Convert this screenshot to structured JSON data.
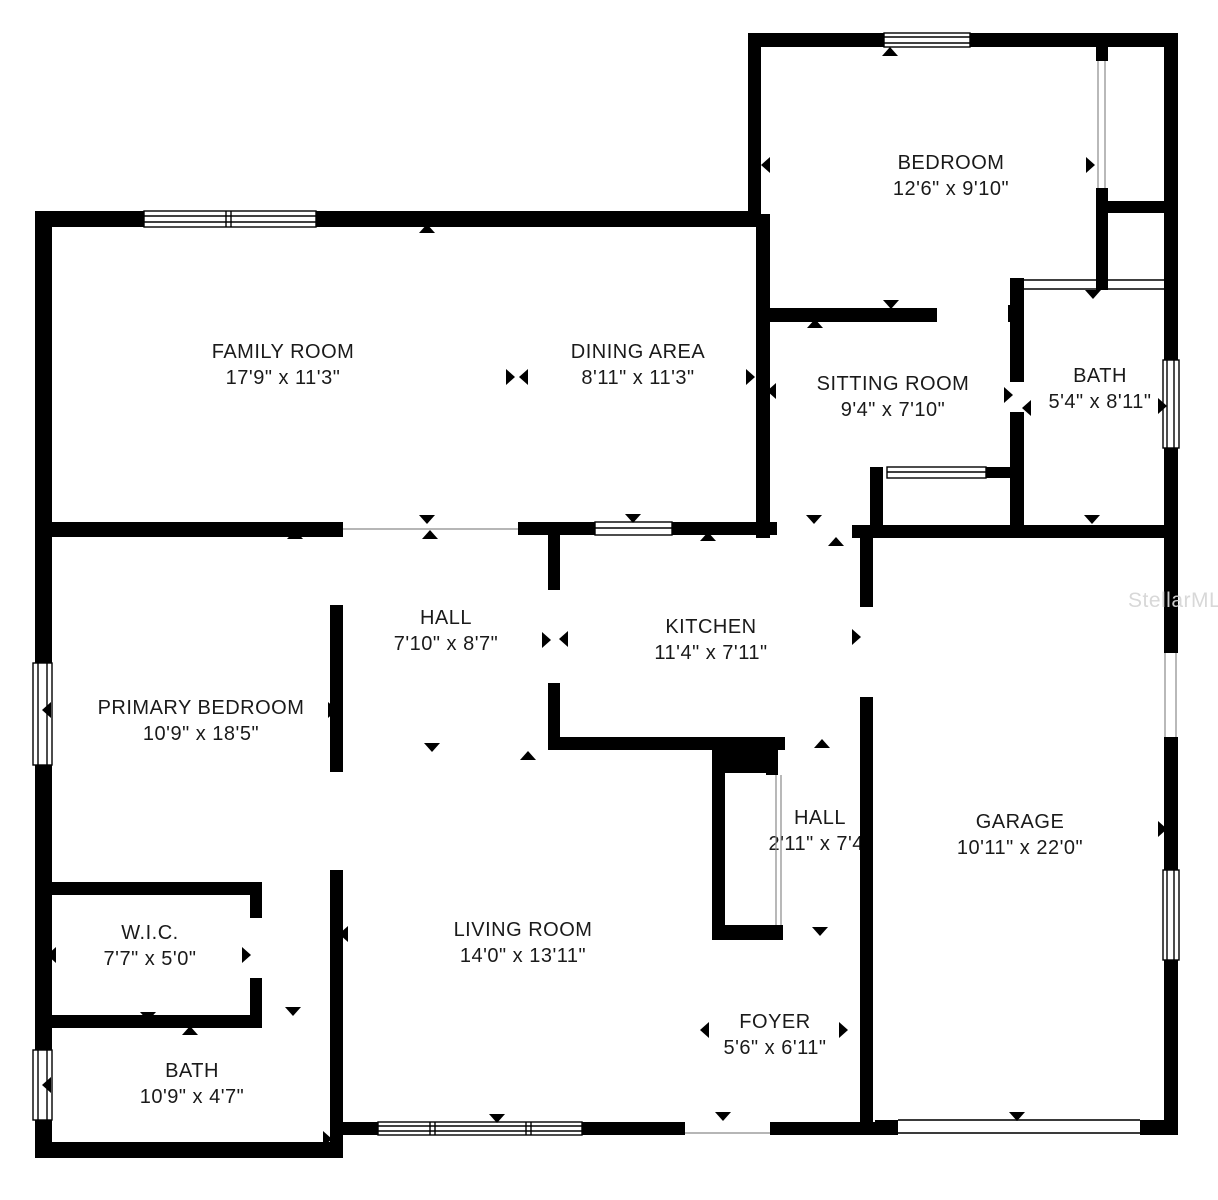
{
  "watermark": "StellarMLS",
  "rooms": [
    {
      "name": "FAMILY ROOM",
      "dims": "17'9\" x 11'3\""
    },
    {
      "name": "DINING AREA",
      "dims": "8'11\" x 11'3\""
    },
    {
      "name": "BEDROOM",
      "dims": "12'6\" x 9'10\""
    },
    {
      "name": "SITTING ROOM",
      "dims": "9'4\" x 7'10\""
    },
    {
      "name": "BATH",
      "dims": "5'4\" x 8'11\""
    },
    {
      "name": "HALL",
      "dims": "7'10\" x 8'7\""
    },
    {
      "name": "KITCHEN",
      "dims": "11'4\" x 7'11\""
    },
    {
      "name": "PRIMARY BEDROOM",
      "dims": "10'9\" x 18'5\""
    },
    {
      "name": "GARAGE",
      "dims": "10'11\" x 22'0\""
    },
    {
      "name": "HALL",
      "dims": "2'11\" x 7'4\""
    },
    {
      "name": "LIVING ROOM",
      "dims": "14'0\" x 13'11\""
    },
    {
      "name": "W.I.C.",
      "dims": "7'7\" x 5'0\""
    },
    {
      "name": "BATH",
      "dims": "10'9\" x 4'7\""
    },
    {
      "name": "FOYER",
      "dims": "5'6\" x 6'11\""
    }
  ]
}
